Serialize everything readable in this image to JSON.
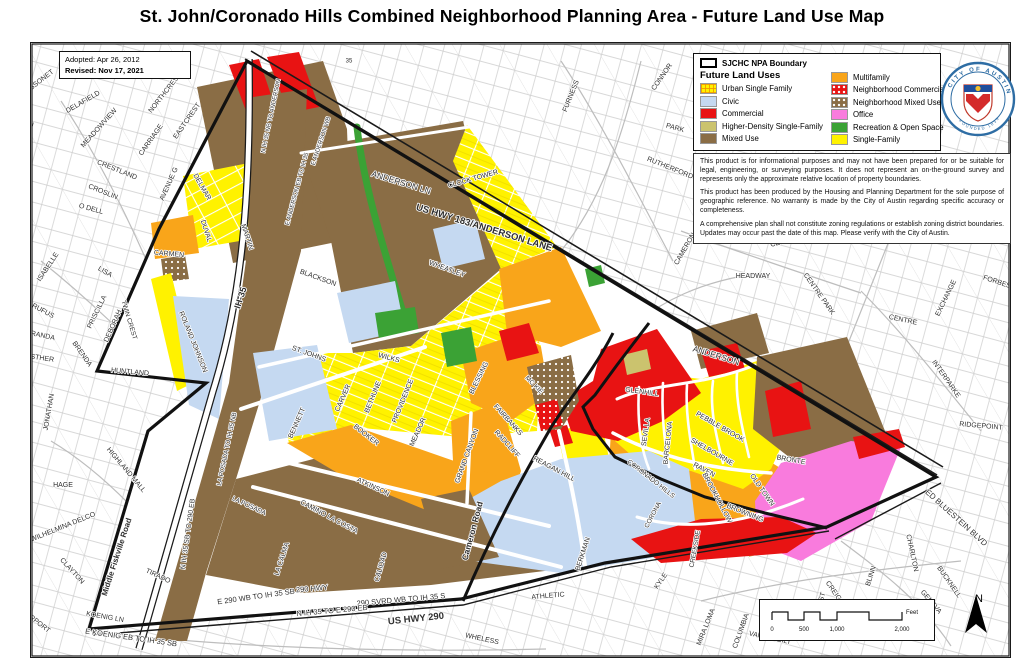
{
  "title": "St. John/Coronado Hills Combined Neighborhood Planning Area - Future Land Use Map",
  "map_info": {
    "adopted": "Adopted: Apr 26, 2012",
    "revised": "Revised: Nov 17, 2021"
  },
  "legend": {
    "boundary_label": "SJCHC NPA Boundary",
    "title": "Future Land Uses",
    "col1": [
      {
        "label": "Urban Single Family",
        "pattern": "grid",
        "color": "#FFF200"
      },
      {
        "label": "Civic",
        "pattern": "solid",
        "color": "#C5D9F1"
      },
      {
        "label": "Commercial",
        "pattern": "solid",
        "color": "#E81313"
      },
      {
        "label": "Higher-Density Single-Family",
        "pattern": "solid",
        "color": "#CBC36E"
      },
      {
        "label": "Mixed Use",
        "pattern": "solid",
        "color": "#8A6D45"
      }
    ],
    "col2": [
      {
        "label": "Multifamily",
        "pattern": "solid",
        "color": "#F9A51A"
      },
      {
        "label": "Neighborhood Commercial",
        "pattern": "dots",
        "color": "#E81313"
      },
      {
        "label": "Neighborhood Mixed Use",
        "pattern": "dots",
        "color": "#8A6D45"
      },
      {
        "label": "Office",
        "pattern": "solid",
        "color": "#F97BDD"
      },
      {
        "label": "Recreation & Open Space",
        "pattern": "solid",
        "color": "#3BA235"
      },
      {
        "label": "Single-Family",
        "pattern": "solid",
        "color": "#FFF200"
      }
    ]
  },
  "disclaimer": [
    "This product is for informational purposes and may not have been prepared for or be suitable for legal, engineering, or surveying purposes.  It does not represent an on-the-ground survey and represents only the approximate relative location of property boundaries.",
    "This product has been produced by the Housing and Planning Department for the sole purpose of geographic reference.  No warranty is made by the City of Austin regarding specific accuracy or completeness.",
    "A comprehensive plan shall not constitute zoning regulations or establish zoning district boundaries. Updates may occur past the date of this map. Please verify with the City of Austin."
  ],
  "seal": {
    "ring_top": "CITY OF AUSTIN",
    "ring_bottom": "FOUNDED 1839"
  },
  "scale_bar": {
    "ticks": [
      "0",
      "500",
      "1,000",
      "2,000"
    ],
    "unit": "Feet"
  },
  "north_label": "N",
  "street_labels": [
    {
      "t": "BISSONET",
      "x": 38,
      "y": 81,
      "r": -38
    },
    {
      "t": "DELAFIELD",
      "x": 82,
      "y": 101,
      "r": -30
    },
    {
      "t": "GUADALUPE",
      "x": 26,
      "y": 142,
      "r": -77
    },
    {
      "t": "MEADOWVIEW",
      "x": 98,
      "y": 127,
      "r": -48
    },
    {
      "t": "NORTHCREST",
      "x": 164,
      "y": 92,
      "r": -52
    },
    {
      "t": "CARRIAGE",
      "x": 150,
      "y": 139,
      "r": -55
    },
    {
      "t": "EASTCREST",
      "x": 186,
      "y": 120,
      "r": -55
    },
    {
      "t": "CRESTLAND",
      "x": 116,
      "y": 169,
      "r": 22
    },
    {
      "t": "CROSLIN",
      "x": 102,
      "y": 191,
      "r": 22
    },
    {
      "t": "O DELL",
      "x": 90,
      "y": 208,
      "r": 15
    },
    {
      "t": "AVENUE G",
      "x": 168,
      "y": 183,
      "r": -66
    },
    {
      "t": "ISABELLE",
      "x": 47,
      "y": 266,
      "r": -56
    },
    {
      "t": "LISA",
      "x": 104,
      "y": 271,
      "r": 30
    },
    {
      "t": "RUFUS",
      "x": 42,
      "y": 310,
      "r": 28
    },
    {
      "t": "PRISCILLA",
      "x": 96,
      "y": 311,
      "r": -64
    },
    {
      "t": "MIRANDA",
      "x": 38,
      "y": 334,
      "r": 12
    },
    {
      "t": "DEBORAH",
      "x": 112,
      "y": 325,
      "r": -66
    },
    {
      "t": "BRENDA",
      "x": 81,
      "y": 353,
      "r": 55
    },
    {
      "t": "ESTHER",
      "x": 39,
      "y": 357,
      "r": 8
    },
    {
      "t": "JONATHAN",
      "x": 48,
      "y": 411,
      "r": -80
    },
    {
      "t": "HUNTLAND",
      "x": 129,
      "y": 371,
      "r": 5
    },
    {
      "t": "HAGE",
      "x": 62,
      "y": 484,
      "r": 0
    },
    {
      "t": "WILHELMINA DELCO",
      "x": 62,
      "y": 526,
      "r": -22
    },
    {
      "t": "HIGHLAND MALL",
      "x": 125,
      "y": 469,
      "r": 50
    },
    {
      "t": "CLAYTON",
      "x": 71,
      "y": 570,
      "r": 48
    },
    {
      "t": "AIRPORT",
      "x": 36,
      "y": 621,
      "r": 38
    },
    {
      "t": "KOENIG LN",
      "x": 104,
      "y": 616,
      "r": 10
    },
    {
      "t": "E KOENIG EB TO IH 35 SB",
      "x": 130,
      "y": 637,
      "r": 8,
      "s": 7.5
    },
    {
      "t": "TIRADO",
      "x": 157,
      "y": 575,
      "r": 25
    },
    {
      "t": "DELMAR",
      "x": 201,
      "y": 186,
      "r": 60
    },
    {
      "t": "DUVAL",
      "x": 205,
      "y": 230,
      "r": 72
    },
    {
      "t": "MARTIN",
      "x": 246,
      "y": 236,
      "r": 72
    },
    {
      "t": "CARMEN",
      "x": 168,
      "y": 253,
      "r": 5
    },
    {
      "t": "TWIN CREST",
      "x": 128,
      "y": 319,
      "r": 73,
      "s": 6.5
    },
    {
      "t": "ROLAND JOHNSON",
      "x": 192,
      "y": 341,
      "r": 68
    },
    {
      "t": "IH-35",
      "x": 240,
      "y": 297,
      "r": -72,
      "w": 700,
      "s": 9
    },
    {
      "t": "LA POSADA TO IH 35 NB",
      "x": 226,
      "y": 448,
      "r": -78,
      "s": 6.5
    },
    {
      "t": "N IH 35 SB TO 290 EB",
      "x": 187,
      "y": 533,
      "r": -82,
      "s": 7
    },
    {
      "t": "Middle Fiskville Road",
      "x": 116,
      "y": 556,
      "r": -72,
      "w": 700,
      "s": 8
    },
    {
      "t": "LA POSADA",
      "x": 248,
      "y": 505,
      "r": 25,
      "s": 6.5
    },
    {
      "t": "LA CALMA",
      "x": 281,
      "y": 558,
      "r": -72
    },
    {
      "t": "CALIDAD",
      "x": 380,
      "y": 566,
      "r": -74
    },
    {
      "t": "N IH 35 NB TO ANDERSON",
      "x": 270,
      "y": 115,
      "r": -78,
      "s": 6
    },
    {
      "t": "E ANDERSON EB TO IH 35",
      "x": 296,
      "y": 188,
      "r": -75,
      "s": 6
    },
    {
      "t": "E ANDERSON WB",
      "x": 320,
      "y": 140,
      "r": -72,
      "s": 6
    },
    {
      "t": "E 290 WB TO IH 35 SB",
      "x": 255,
      "y": 596,
      "r": -8,
      "s": 7.5
    },
    {
      "t": "290 HWY",
      "x": 311,
      "y": 588,
      "r": -5,
      "s": 7.5
    },
    {
      "t": "290 SVRD WB TO IH 35 S",
      "x": 400,
      "y": 599,
      "r": -5,
      "s": 7.5
    },
    {
      "t": "N IH 35 TO E 290 EB",
      "x": 331,
      "y": 610,
      "r": -5,
      "s": 7.5
    },
    {
      "t": "US HWY 290",
      "x": 415,
      "y": 618,
      "r": -6,
      "w": 700,
      "s": 9.5
    },
    {
      "t": "WHELESS",
      "x": 481,
      "y": 638,
      "r": 12
    },
    {
      "t": "ATHLETIC",
      "x": 547,
      "y": 595,
      "r": -5
    },
    {
      "t": "ANDERSON LN",
      "x": 400,
      "y": 182,
      "r": 17,
      "s": 8.5
    },
    {
      "t": "US HWY 183/ANDERSON LANE",
      "x": 483,
      "y": 227,
      "r": 17,
      "w": 700,
      "s": 9.5
    },
    {
      "t": "CLOCK TOWER",
      "x": 472,
      "y": 178,
      "r": -16
    },
    {
      "t": "NORWOOD PARK",
      "x": 735,
      "y": 66,
      "r": 0
    },
    {
      "t": "35",
      "x": 348,
      "y": 60,
      "r": 0,
      "s": 6
    },
    {
      "t": "BLACKSON",
      "x": 317,
      "y": 277,
      "r": 20
    },
    {
      "t": "WHEATLEY",
      "x": 446,
      "y": 268,
      "r": 20
    },
    {
      "t": "ST. JOHNS",
      "x": 308,
      "y": 353,
      "r": 20
    },
    {
      "t": "WILKS",
      "x": 388,
      "y": 357,
      "r": 15
    },
    {
      "t": "BENNETT",
      "x": 296,
      "y": 422,
      "r": -66
    },
    {
      "t": "CARVER",
      "x": 342,
      "y": 397,
      "r": -66
    },
    {
      "t": "BETHUNE",
      "x": 372,
      "y": 396,
      "r": -68
    },
    {
      "t": "PROVIDENCE",
      "x": 402,
      "y": 400,
      "r": -68
    },
    {
      "t": "BOOKER",
      "x": 365,
      "y": 434,
      "r": 38
    },
    {
      "t": "MEADOR",
      "x": 417,
      "y": 431,
      "r": -66
    },
    {
      "t": "BLESSING",
      "x": 478,
      "y": 377,
      "r": -64
    },
    {
      "t": "ATKINSON",
      "x": 372,
      "y": 486,
      "r": 25
    },
    {
      "t": "CAMINO LA COSTA",
      "x": 328,
      "y": 516,
      "r": 28
    },
    {
      "t": "GRAND CANYON",
      "x": 466,
      "y": 455,
      "r": -70
    },
    {
      "t": "FAIRBANKS",
      "x": 507,
      "y": 419,
      "r": 48
    },
    {
      "t": "RADCLIFF",
      "x": 506,
      "y": 443,
      "r": 48
    },
    {
      "t": "MC KIE",
      "x": 533,
      "y": 384,
      "r": 45,
      "s": 6.5
    },
    {
      "t": "Cameron Road",
      "x": 472,
      "y": 530,
      "r": -75,
      "w": 700,
      "s": 8.5
    },
    {
      "t": "REAGAN HILL",
      "x": 553,
      "y": 468,
      "r": 28
    },
    {
      "t": "BERKMAN",
      "x": 582,
      "y": 553,
      "r": -72
    },
    {
      "t": "KYLE",
      "x": 660,
      "y": 580,
      "r": -55
    },
    {
      "t": "ANDERSON",
      "x": 715,
      "y": 355,
      "r": 17,
      "s": 8.5
    },
    {
      "t": "GLENHILL",
      "x": 641,
      "y": 391,
      "r": 8
    },
    {
      "t": "SEVILLA",
      "x": 645,
      "y": 431,
      "r": -82
    },
    {
      "t": "BARCELONA",
      "x": 667,
      "y": 442,
      "r": -84
    },
    {
      "t": "PEBBLE BROOK",
      "x": 719,
      "y": 426,
      "r": 30
    },
    {
      "t": "SHELBOURNE",
      "x": 711,
      "y": 451,
      "r": 30
    },
    {
      "t": "RAVEN",
      "x": 703,
      "y": 469,
      "r": 28
    },
    {
      "t": "BROOKHOLLOW",
      "x": 716,
      "y": 497,
      "r": 62
    },
    {
      "t": "OLD TOWN",
      "x": 761,
      "y": 489,
      "r": 55
    },
    {
      "t": "BRONTE",
      "x": 790,
      "y": 459,
      "r": 10
    },
    {
      "t": "BROWNING",
      "x": 744,
      "y": 512,
      "r": 22
    },
    {
      "t": "CORONADO HILLS",
      "x": 650,
      "y": 478,
      "r": 38,
      "s": 6.5
    },
    {
      "t": "CORONA",
      "x": 652,
      "y": 514,
      "r": -62,
      "s": 6.5
    },
    {
      "t": "CREEKSIDE",
      "x": 694,
      "y": 548,
      "r": -80,
      "s": 6.5
    },
    {
      "t": "CONNOR",
      "x": 661,
      "y": 76,
      "r": -55
    },
    {
      "t": "FURNESS",
      "x": 570,
      "y": 95,
      "r": -68
    },
    {
      "t": "PARK",
      "x": 674,
      "y": 127,
      "r": 15
    },
    {
      "t": "RUTHERFORD",
      "x": 669,
      "y": 167,
      "r": 22
    },
    {
      "t": "CAMERON",
      "x": 684,
      "y": 248,
      "r": -60
    },
    {
      "t": "HEADWAY",
      "x": 752,
      "y": 275,
      "r": 0
    },
    {
      "t": "CENTRE CREEK",
      "x": 796,
      "y": 237,
      "r": -15
    },
    {
      "t": "CENTRE PARK",
      "x": 818,
      "y": 293,
      "r": 55
    },
    {
      "t": "CROSS PARK",
      "x": 978,
      "y": 228,
      "r": 8
    },
    {
      "t": "FORBES",
      "x": 996,
      "y": 281,
      "r": 18
    },
    {
      "t": "EXCHANGE",
      "x": 945,
      "y": 297,
      "r": -64
    },
    {
      "t": "CENTRE",
      "x": 902,
      "y": 319,
      "r": 12
    },
    {
      "t": "INTERPARKE",
      "x": 945,
      "y": 378,
      "r": 55
    },
    {
      "t": "RIDGEPOINT",
      "x": 980,
      "y": 425,
      "r": 5
    },
    {
      "t": "ED BLUESTEIN BLVD",
      "x": 955,
      "y": 517,
      "r": 42,
      "s": 8
    },
    {
      "t": "CHARLTON",
      "x": 911,
      "y": 552,
      "r": 78
    },
    {
      "t": "BLINN",
      "x": 870,
      "y": 575,
      "r": -72
    },
    {
      "t": "BUCKNELL",
      "x": 948,
      "y": 581,
      "r": 55
    },
    {
      "t": "GENEVA",
      "x": 930,
      "y": 601,
      "r": 50
    },
    {
      "t": "CREIGHTON",
      "x": 838,
      "y": 598,
      "r": 55
    },
    {
      "t": "MIRA LOMA",
      "x": 705,
      "y": 626,
      "r": -68
    },
    {
      "t": "COLUMBIA",
      "x": 740,
      "y": 630,
      "r": -70
    },
    {
      "t": "VANDERBILT",
      "x": 769,
      "y": 637,
      "r": 12
    },
    {
      "t": "NORTHEAST",
      "x": 816,
      "y": 612,
      "r": -72
    }
  ]
}
